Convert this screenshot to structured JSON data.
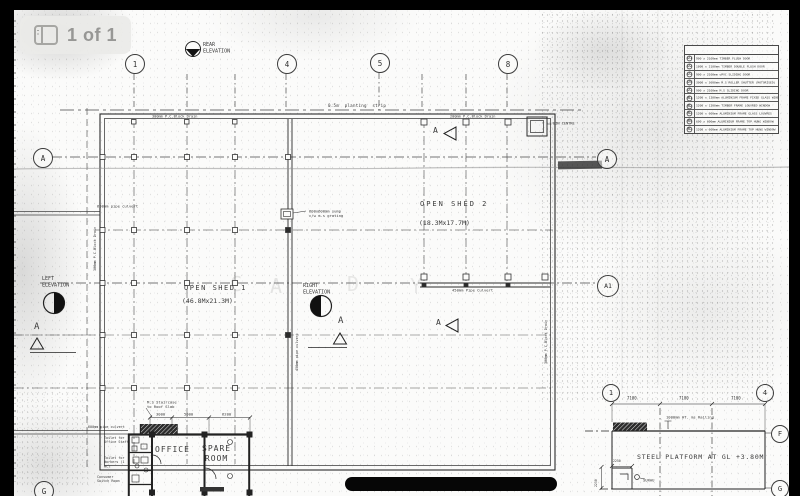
{
  "viewer": {
    "page_indicator": "1 of 1",
    "colors": {
      "pill_bg": "#ebebe8",
      "pill_text": "#979795",
      "ink": "#3a3a3a",
      "paper": "#fbfbfa"
    }
  },
  "legend": {
    "title": "DOOR & WINDOW SCHEDULE",
    "rows": [
      {
        "code": "D1",
        "desc": "900 x 2100mm TIMBER FLUSH DOOR"
      },
      {
        "code": "D2",
        "desc": "1800 x 2100mm TIMBER DOUBLE FLUSH DOOR"
      },
      {
        "code": "D3",
        "desc": "900 x 2100mm uPVC SLIDING DOOR"
      },
      {
        "code": "D4",
        "desc": "3000 x 3600mm M.S ROLLER SHUTTER (MOTORISED)"
      },
      {
        "code": "D5",
        "desc": "900 x 2100mm M.S SLIDING DOOR"
      },
      {
        "code": "W1",
        "desc": "1200 x 1200mm ALUMINIUM FRAME FIXED GLASS WINDOW"
      },
      {
        "code": "W2",
        "desc": "1200 x 1200mm TIMBER FRAME LOUVRED WINDOW"
      },
      {
        "code": "W3",
        "desc": "1200 x 600mm ALUMINIUM FRAME GLASS LOUVRES"
      },
      {
        "code": "W4",
        "desc": "600 x 600mm ALUMINIUM FRAME TOP HUNG WINDOW"
      },
      {
        "code": "W5",
        "desc": "1200 x 600mm ALUMINIUM FRAME TOP HUNG WINDOW"
      }
    ]
  },
  "bubbles": [
    {
      "n": "grid-bubble-1-top",
      "l": "1",
      "x": 134,
      "y": 63,
      "r": 9,
      "fs": 7.5
    },
    {
      "n": "grid-bubble-4-top",
      "l": "4",
      "x": 286,
      "y": 63,
      "r": 9,
      "fs": 7.5
    },
    {
      "n": "grid-bubble-5-top",
      "l": "5",
      "x": 379,
      "y": 62,
      "r": 9,
      "fs": 7.5
    },
    {
      "n": "grid-bubble-8-top",
      "l": "8",
      "x": 507,
      "y": 63,
      "r": 9,
      "fs": 7.5
    },
    {
      "n": "grid-bubble-a-left",
      "l": "A",
      "x": 42,
      "y": 157,
      "r": 9,
      "fs": 7.5
    },
    {
      "n": "grid-bubble-a-right",
      "l": "A",
      "x": 606,
      "y": 158,
      "r": 9,
      "fs": 7.5
    },
    {
      "n": "grid-bubble-a1-right",
      "l": "A1",
      "x": 607,
      "y": 285,
      "r": 10,
      "fs": 6.5
    },
    {
      "n": "grid-bubble-g-left",
      "l": "G",
      "x": 43,
      "y": 490,
      "r": 9,
      "fs": 7.5
    },
    {
      "n": "platform-bubble-1",
      "l": "1",
      "x": 610,
      "y": 392,
      "r": 8,
      "fs": 7
    },
    {
      "n": "platform-bubble-4",
      "l": "4",
      "x": 764,
      "y": 392,
      "r": 8,
      "fs": 7
    },
    {
      "n": "platform-bubble-f",
      "l": "F",
      "x": 779,
      "y": 433,
      "r": 8,
      "fs": 7
    },
    {
      "n": "platform-bubble-g",
      "l": "G",
      "x": 779,
      "y": 488,
      "r": 8,
      "fs": 7
    }
  ],
  "annotations": [
    {
      "n": "rear-elevation-label",
      "text": "REAR\nELEVATION",
      "x": 203,
      "y": 42,
      "fs": 5
    },
    {
      "n": "planting-strip-label",
      "text": "0.5m  planting  strip",
      "x": 328,
      "y": 103,
      "fs": 4.2,
      "ls": 0.5
    },
    {
      "n": "drain-label-top-left",
      "text": "300mm P.C.Block Drain",
      "x": 152,
      "y": 114,
      "fs": 3.6
    },
    {
      "n": "drain-label-top-right",
      "text": "200mm P.C.Block Drain",
      "x": 450,
      "y": 114,
      "fs": 3.6
    },
    {
      "n": "bin-centre-label",
      "text": "BIN CENTRE",
      "x": 553,
      "y": 121,
      "fs": 3.6
    },
    {
      "n": "open-shed2-label",
      "text": "OPEN SHED 2",
      "x": 420,
      "y": 200,
      "fs": 7,
      "ls": 2
    },
    {
      "n": "open-shed2-dim",
      "text": "(18.3Mx17.7M)",
      "x": 419,
      "y": 219,
      "fs": 6.5
    },
    {
      "n": "open-shed1-label",
      "text": "OPEN SHED 1",
      "x": 184,
      "y": 284,
      "fs": 7,
      "ls": 1.5
    },
    {
      "n": "open-shed1-dim",
      "text": "(46.8Mx21.3M)",
      "x": 182,
      "y": 297,
      "fs": 6.5
    },
    {
      "n": "left-elevation-label",
      "text": "LEFT\nELEVATION",
      "x": 42,
      "y": 276,
      "fs": 5
    },
    {
      "n": "right-elevation-label",
      "text": "RIGHT\nELEVATION",
      "x": 303,
      "y": 283,
      "fs": 5
    },
    {
      "n": "sump-label",
      "text": "600x600mm sump\nc/w m.s grating",
      "x": 309,
      "y": 209,
      "fs": 3.8
    },
    {
      "n": "culvert-450-label",
      "text": "450mm Pipe Culvert",
      "x": 452,
      "y": 288,
      "fs": 3.8
    },
    {
      "n": "pipe-600-label",
      "text": "600mm pipe culvert",
      "x": 97,
      "y": 204,
      "fs": 3.8
    },
    {
      "n": "drain-left-vertical",
      "text": "300mm P.C.Block Drain",
      "x": 93,
      "y": 271,
      "fs": 3.5,
      "rot": -90
    },
    {
      "n": "culvert-450-vertical",
      "text": "450mm pipe culvert",
      "x": 295,
      "y": 371,
      "fs": 3.5,
      "rot": -90
    },
    {
      "n": "drain-right-vertical",
      "text": "300mm P.C.Block Drain",
      "x": 544,
      "y": 364,
      "fs": 3.5,
      "rot": -90
    },
    {
      "n": "stair-label",
      "text": "M.S Staircase\nto Roof Slab",
      "x": 147,
      "y": 400,
      "fs": 3.8
    },
    {
      "n": "dim-3000",
      "text": "3000",
      "x": 156,
      "y": 412,
      "fs": 3.8
    },
    {
      "n": "dim-5000",
      "text": "5000",
      "x": 184,
      "y": 412,
      "fs": 3.8
    },
    {
      "n": "dim-6200",
      "text": "6200",
      "x": 222,
      "y": 412,
      "fs": 3.8
    },
    {
      "n": "pipe-600-label-2",
      "text": "600mm pipe culvert",
      "x": 88,
      "y": 425,
      "fs": 3.4
    },
    {
      "n": "toilet-office-label",
      "text": "Toilet for\nOffice Staff",
      "x": 104,
      "y": 436,
      "fs": 3.4
    },
    {
      "n": "toilet-workers-label",
      "text": "Toilet for\nWorkers (1\nWC)",
      "x": 104,
      "y": 456,
      "fs": 3.4
    },
    {
      "n": "switch-room-label",
      "text": "Consumer\nSwitch Room",
      "x": 97,
      "y": 475,
      "fs": 3.4
    },
    {
      "n": "office-label",
      "text": "OFFICE",
      "x": 155,
      "y": 445,
      "fs": 8,
      "ls": 1
    },
    {
      "n": "spare-room-label",
      "text": "SPARE\nROOM",
      "x": 202,
      "y": 444,
      "fs": 8,
      "ls": 1,
      "ta": "center"
    },
    {
      "n": "dim-7100-a",
      "text": "7100",
      "x": 627,
      "y": 396,
      "fs": 4
    },
    {
      "n": "dim-7100-b",
      "text": "7100",
      "x": 679,
      "y": 396,
      "fs": 4
    },
    {
      "n": "dim-7100-c",
      "text": "7100",
      "x": 731,
      "y": 396,
      "fs": 4
    },
    {
      "n": "railing-label",
      "text": "1000mm HT. ms Railing",
      "x": 666,
      "y": 415,
      "fs": 3.8
    },
    {
      "n": "platform-label",
      "text": "STEEL PLATFORM AT GL +3.80M",
      "x": 637,
      "y": 453,
      "fs": 6.5,
      "ls": 0.8
    },
    {
      "n": "dim-2250-h",
      "text": "2250",
      "x": 613,
      "y": 459,
      "fs": 3.2
    },
    {
      "n": "dim-2250-v",
      "text": "2250",
      "x": 594,
      "y": 487,
      "fs": 3.2,
      "rot": -90
    },
    {
      "n": "surau-label",
      "text": "SURAU",
      "x": 643,
      "y": 478,
      "fs": 3.8
    },
    {
      "n": "section-a-shed2-top",
      "text": "A",
      "x": 433,
      "y": 126,
      "fs": 8
    },
    {
      "n": "section-a-shed2-bottom",
      "text": "A",
      "x": 436,
      "y": 318,
      "fs": 8
    },
    {
      "n": "section-a-left",
      "text": "A",
      "x": 34,
      "y": 322,
      "fs": 9
    },
    {
      "n": "section-a-mid",
      "text": "A",
      "x": 338,
      "y": 316,
      "fs": 9
    },
    {
      "n": "watermark-c",
      "text": "C",
      "x": 230,
      "y": 272,
      "fs": 20,
      "c": "rgba(110,110,110,0.16)"
    },
    {
      "n": "watermark-a",
      "text": "A",
      "x": 270,
      "y": 274,
      "fs": 20,
      "c": "rgba(110,110,110,0.16)"
    },
    {
      "n": "watermark-d",
      "text": "D",
      "x": 347,
      "y": 272,
      "fs": 20,
      "c": "rgba(110,110,110,0.14)"
    },
    {
      "n": "watermark-y",
      "text": "Y",
      "x": 410,
      "y": 274,
      "fs": 20,
      "c": "rgba(110,110,110,0.13)"
    }
  ]
}
